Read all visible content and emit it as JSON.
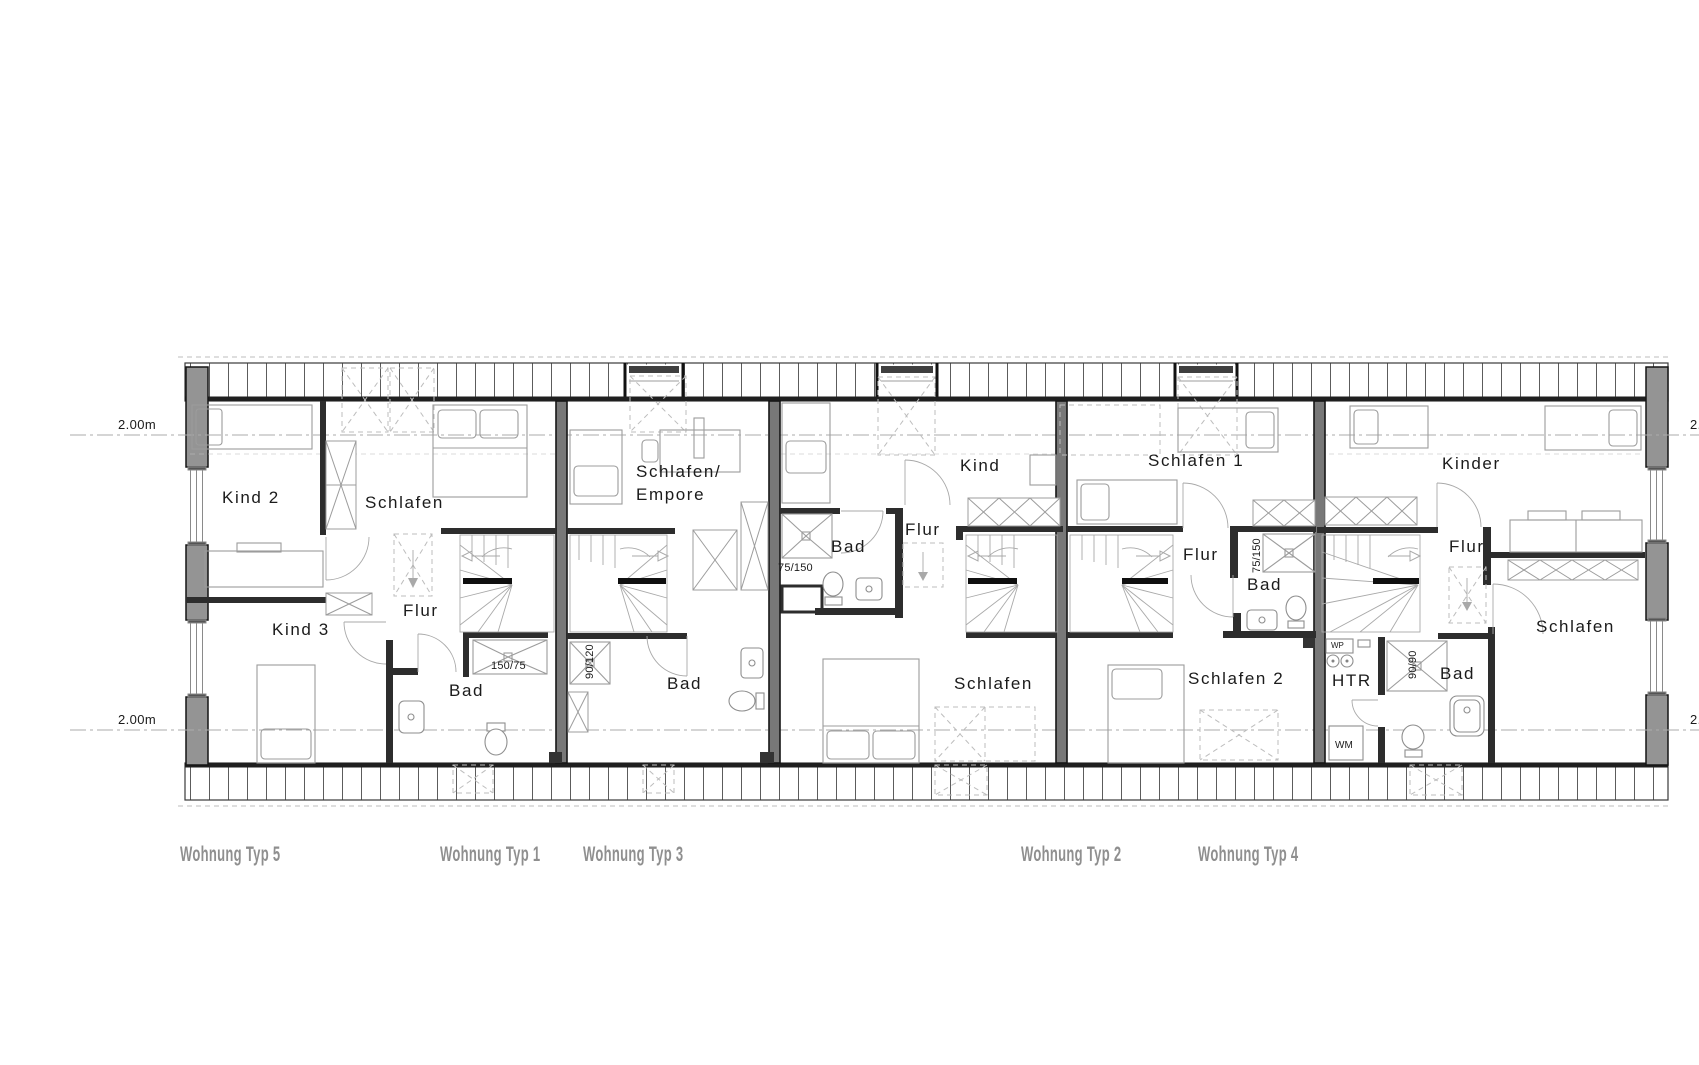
{
  "dimension_labels": {
    "left_top": "2.00m",
    "left_bottom": "2.00m",
    "right_top": "2.00m",
    "right_bottom": "2.00m"
  },
  "apartments": [
    {
      "id": "typ5",
      "label": "Wohnung Typ 5",
      "rooms": {
        "kind2": "Kind 2",
        "schlafen": "Schlafen",
        "kind3": "Kind 3",
        "flur": "Flur",
        "bad": "Bad"
      },
      "fixture_sizes": {
        "shower": "150/75"
      }
    },
    {
      "id": "typ1",
      "label": "Wohnung Typ 1",
      "rooms": {
        "schlafen_empore": "Schlafen/\nEmpore",
        "bad": "Bad"
      },
      "fixture_sizes": {
        "shower": "90/120"
      }
    },
    {
      "id": "typ3",
      "label": "Wohnung Typ 3",
      "rooms": {
        "kind": "Kind",
        "flur": "Flur",
        "bad": "Bad",
        "schlafen": "Schlafen"
      },
      "fixture_sizes": {
        "shower": "75/150"
      }
    },
    {
      "id": "typ2",
      "label": "Wohnung Typ 2",
      "rooms": {
        "schlafen1": "Schlafen 1",
        "flur": "Flur",
        "bad": "Bad",
        "schlafen2": "Schlafen 2"
      },
      "fixture_sizes": {
        "shower": "75/150"
      }
    },
    {
      "id": "typ4",
      "label": "Wohnung Typ 4",
      "rooms": {
        "kinder": "Kinder",
        "flur": "Flur",
        "bad": "Bad",
        "htr": "HTR",
        "schlafen": "Schlafen"
      },
      "fixture_sizes": {
        "shower": "90/90"
      },
      "appliances": {
        "heat_pump": "WP",
        "washing_machine": "WM"
      }
    }
  ],
  "colors": {
    "wall": "#2d2d2d",
    "pier": "#949494",
    "title_gray": "#8f8f8f"
  }
}
